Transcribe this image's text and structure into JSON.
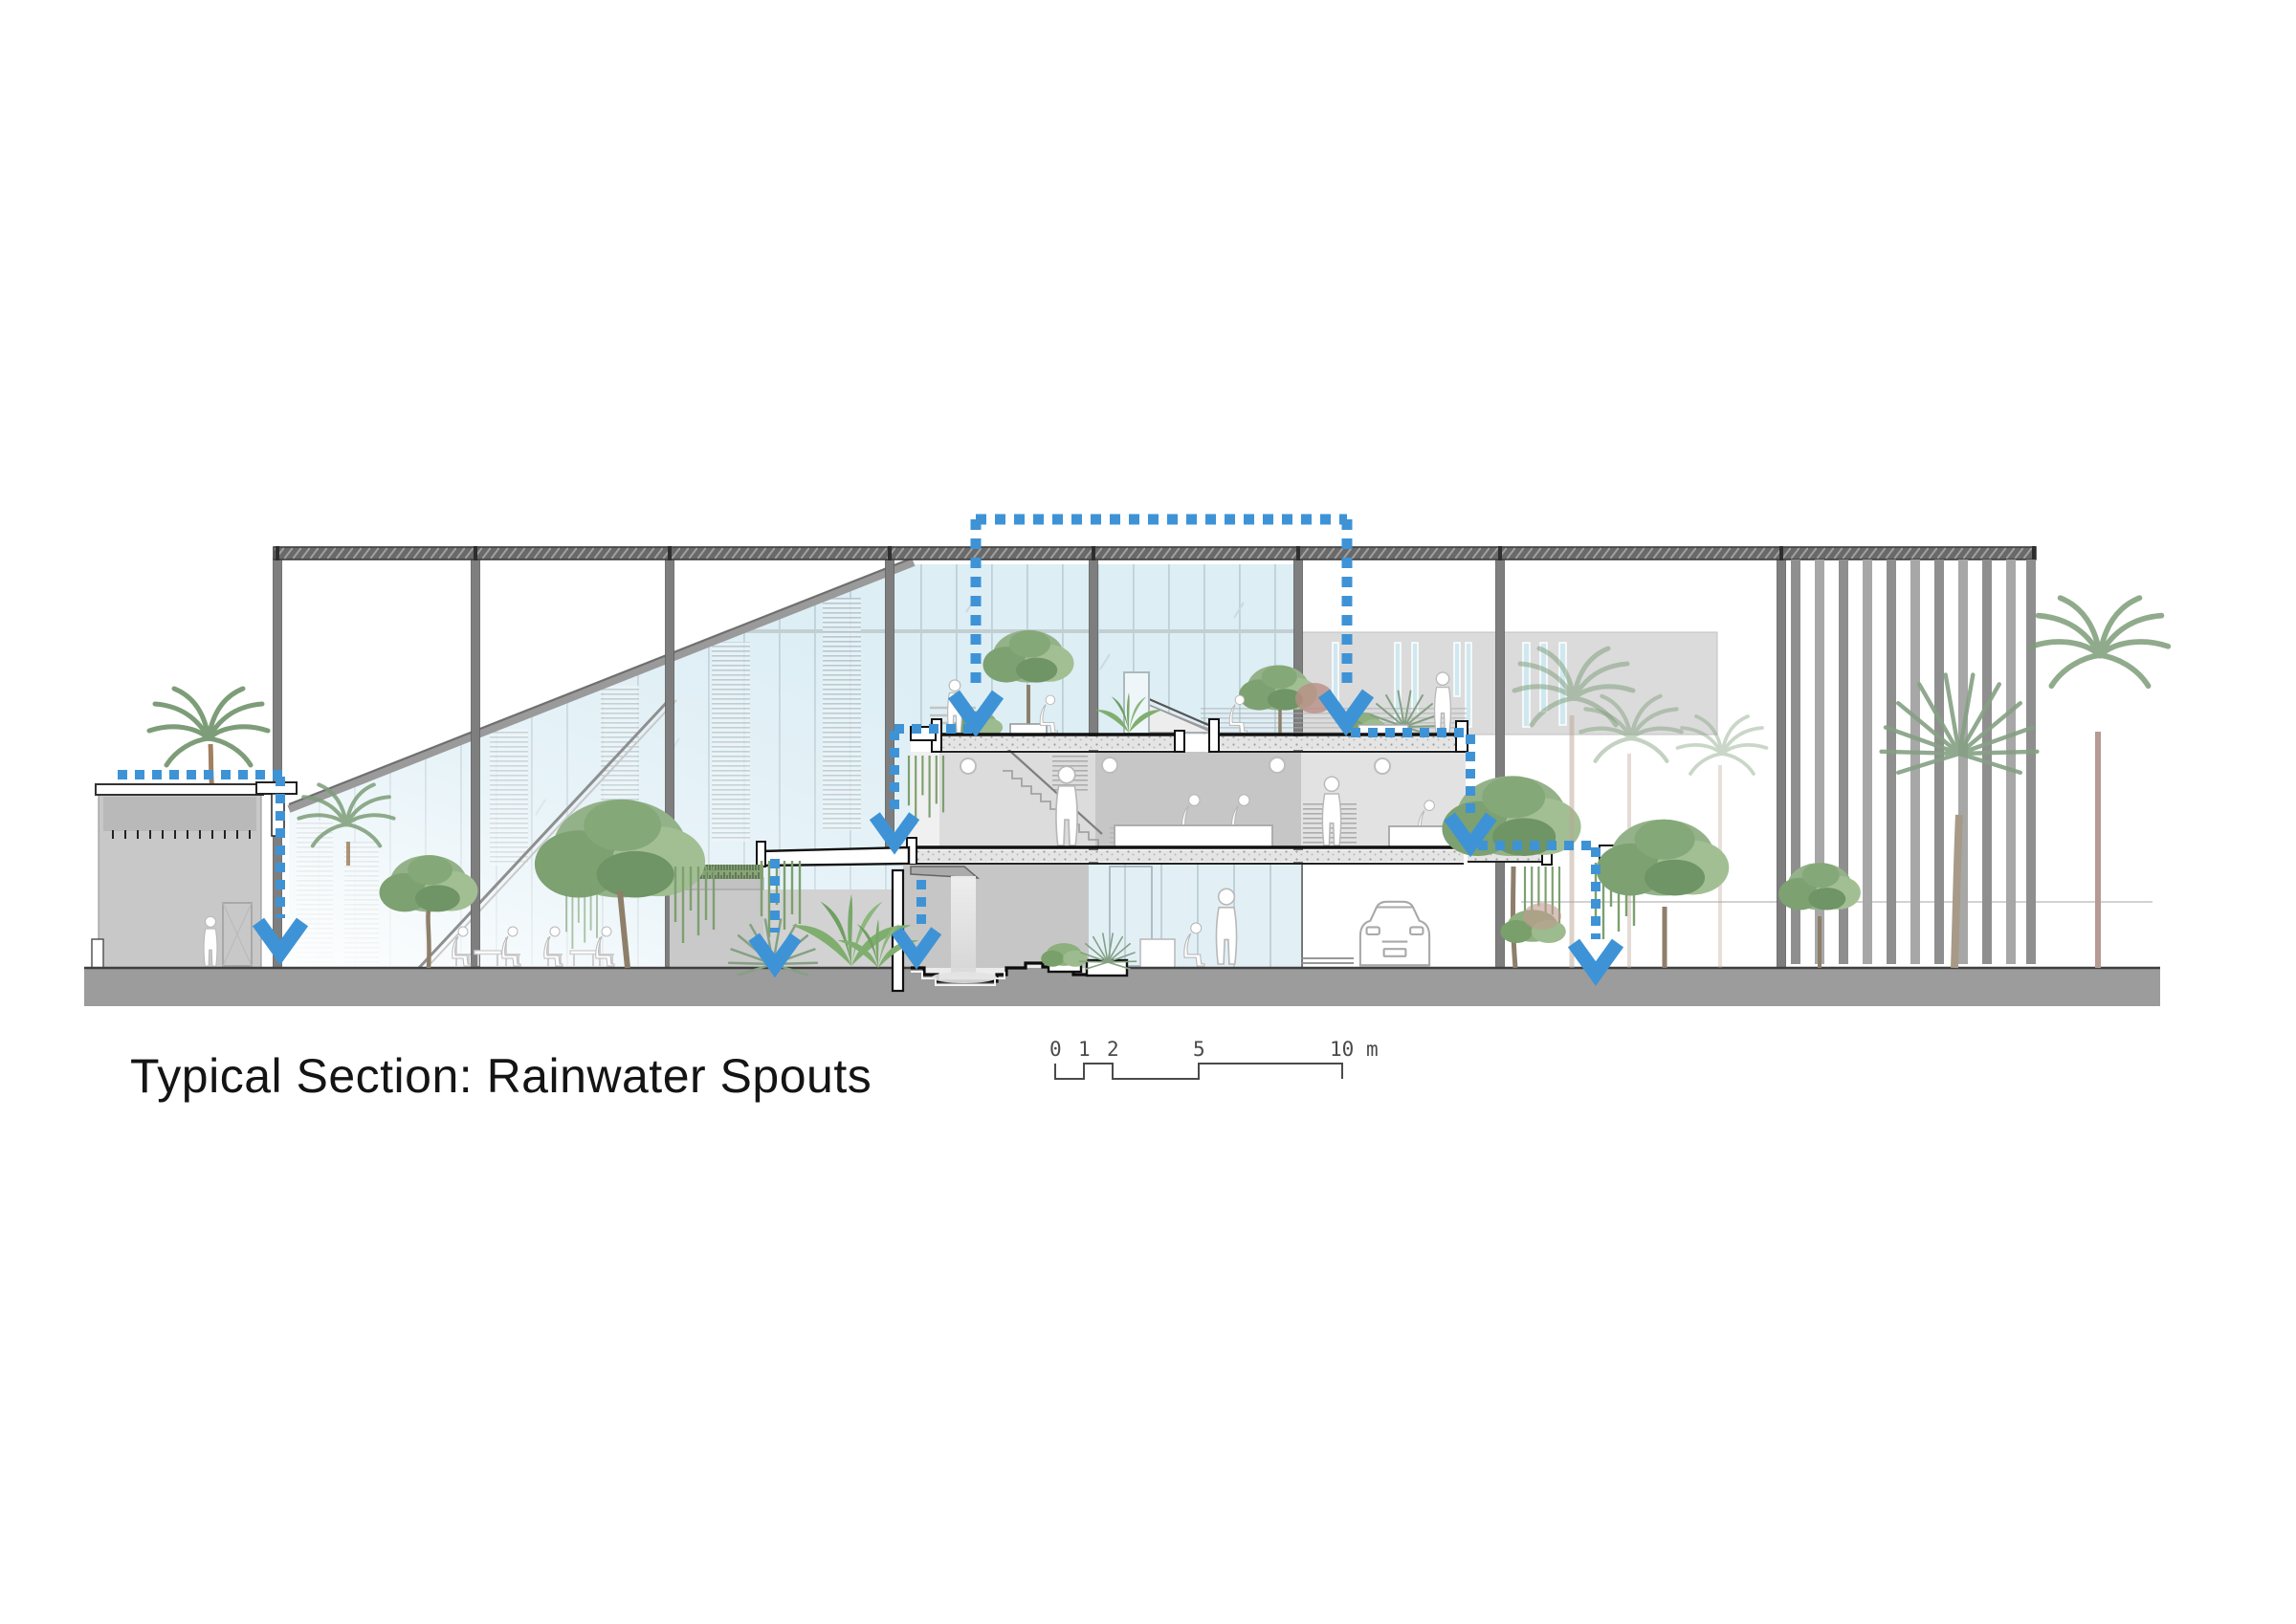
{
  "drawing": {
    "title": "Typical Section: Rainwater Spouts",
    "kind": "architectural-section"
  },
  "scale_bar": {
    "labels": [
      "0",
      "1",
      "2",
      "5",
      "10"
    ],
    "unit": "m"
  },
  "colors": {
    "rainwater_blue": "#3E93D6",
    "glass_tint": "#DDEEF5",
    "structure_gray": "#7E7E7E",
    "roof_gray": "#686868",
    "ground_gray": "#9C9C9C",
    "mass_gray": "#DBDBDB",
    "slab_outline": "#111111",
    "foliage_green": "#8FAE84",
    "trunk_brown": "#9B8A74"
  }
}
